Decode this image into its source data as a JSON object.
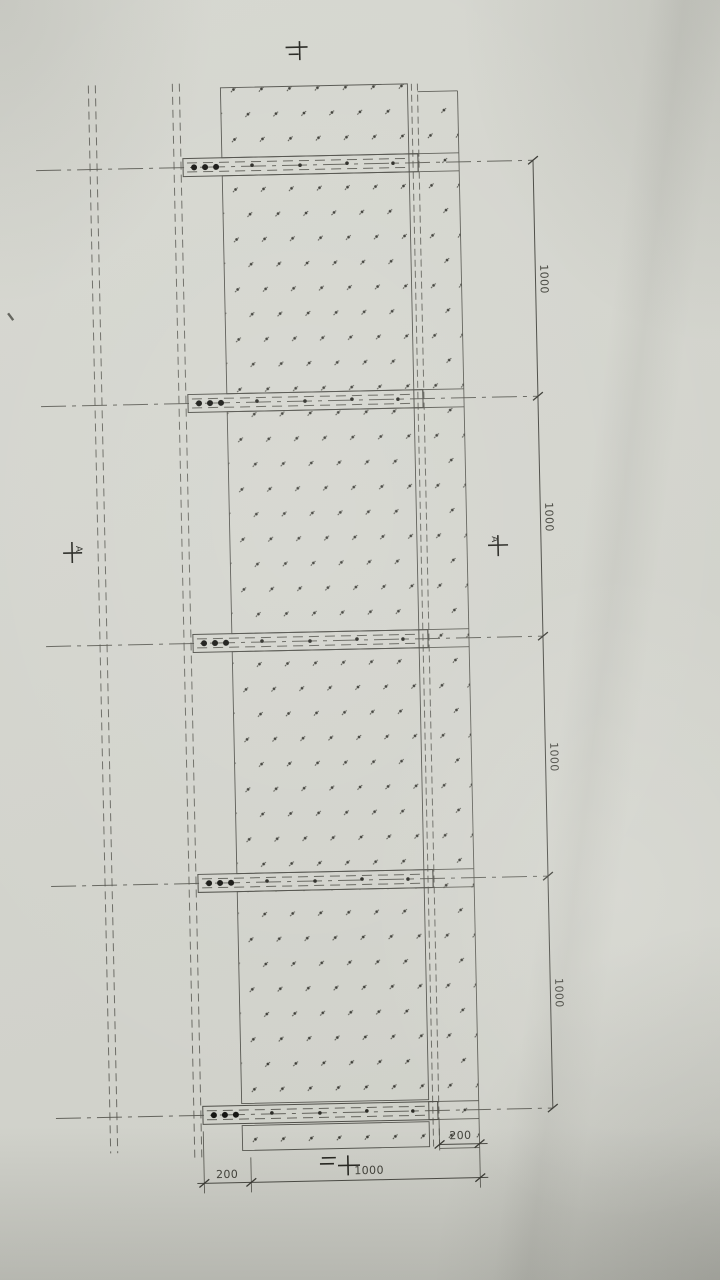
{
  "drawing": {
    "dim_right_labels": [
      "1000",
      "1000",
      "1000",
      "1000"
    ],
    "dim_bottom": {
      "left": "200",
      "main": "1000",
      "right": "200"
    },
    "axis_markers": {
      "left": "A",
      "right": "A"
    }
  },
  "colors": {
    "paper": "#d3d4cd",
    "line": "#52524b",
    "ink": "#161613",
    "dim_text": "#43433c"
  }
}
